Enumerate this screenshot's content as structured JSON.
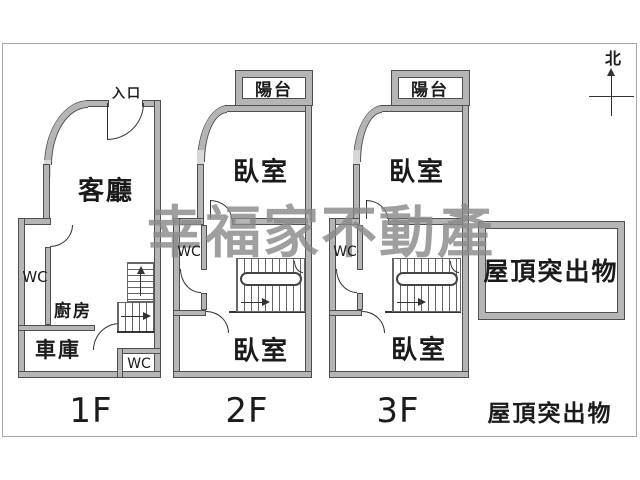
{
  "colors": {
    "wall_fill": "#b5b5b5",
    "wall_edge": "#4f4f4f",
    "line": "#333333",
    "text": "#1b1b1b",
    "watermark": "#8a8a8a",
    "frame": "#a9a9a9",
    "window": "#d8d8d8",
    "bg": "#ffffff"
  },
  "watermark": "幸福家不動產",
  "compass": {
    "north": "北"
  },
  "floor1": {
    "label": "1F",
    "entrance": "入口",
    "living_room": "客廳",
    "wc_side": "WC",
    "kitchen": "廚房",
    "garage": "車庫",
    "wc_corner": "WC"
  },
  "floor2": {
    "label": "2F",
    "balcony": "陽台",
    "bedroom_upper": "臥室",
    "wc": "WC",
    "bedroom_lower": "臥室"
  },
  "floor3": {
    "label": "3F",
    "balcony": "陽台",
    "bedroom_upper": "臥室",
    "wc": "WC",
    "bedroom_lower": "臥室"
  },
  "rooftop": {
    "room": "屋頂突出物",
    "label": "屋頂突出物"
  }
}
